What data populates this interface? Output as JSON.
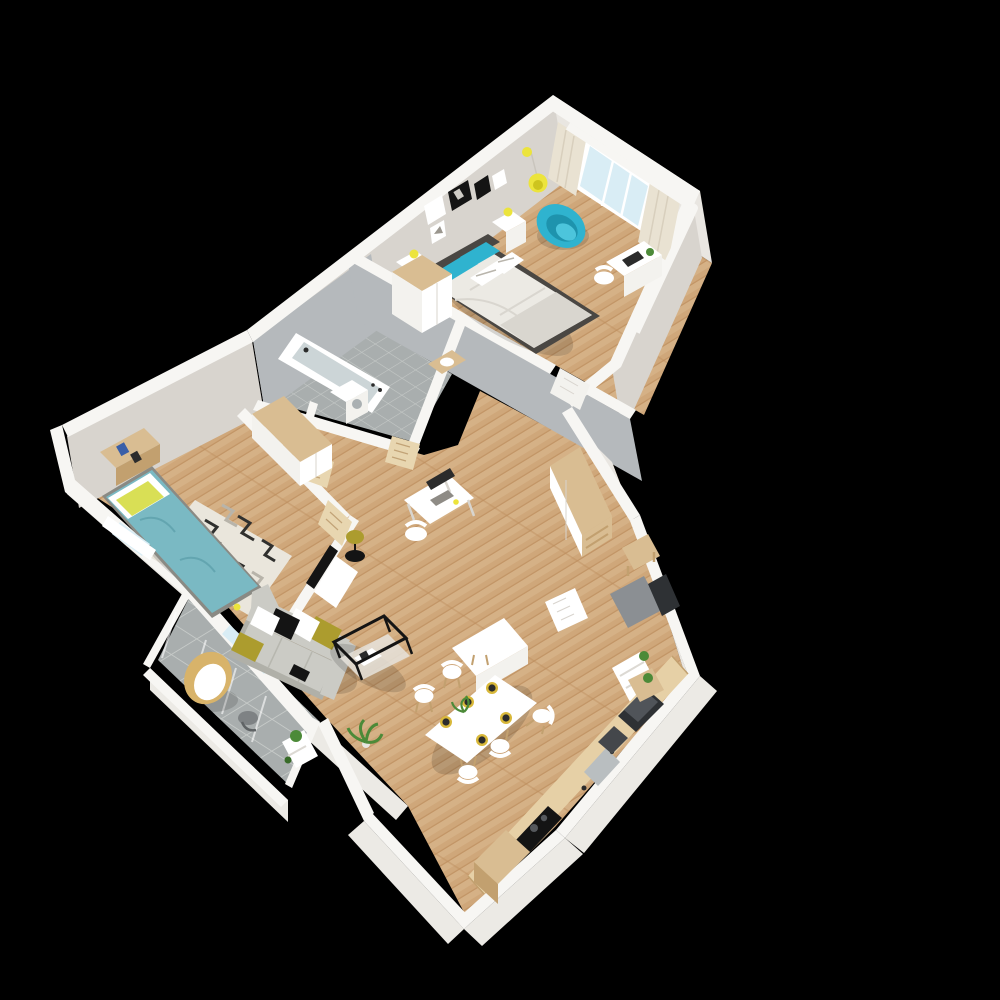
{
  "scene": {
    "type": "3d-floor-plan-render",
    "view": "isometric-top-down",
    "background": "#000000",
    "description": "3D rendered floor plan of a two-bedroom apartment with furniture, shown floating on a black background"
  },
  "palette": {
    "bg": "#000000",
    "wallTop": "#f7f6f3",
    "wallFaceLight": "#e9e6e1",
    "wallFaceShade": "#d8d4ce",
    "wallFaceGrey": "#b5b9bc",
    "wallSkirt": "#eceae5",
    "floorWood": "#cfa77a",
    "floorWoodLight": "#ddbf95",
    "floorWoodDark": "#bd8f5e",
    "tileGrey": "#a9aeae",
    "tileGrout": "#c6cac8",
    "teal": "#2fb3cf",
    "tealDark": "#1e93ad",
    "tealLight": "#4cc5dc",
    "kidsTeal": "#7ab9c3",
    "kidsTealDark": "#63a5b0",
    "yellow": "#ece43c",
    "yellowPillow": "#d9df55",
    "olive": "#ac9c2e",
    "sofaGrey": "#cbcbc5",
    "sofaGreyDark": "#b0b0a8",
    "white": "#ffffff",
    "offWhite": "#f3f2ee",
    "woodFurn": "#d9bd92",
    "woodFurnDark": "#c2a06f",
    "counterWood": "#e6d0a6",
    "dark": "#2b2b2b",
    "black": "#141414",
    "appliance": "#44474b",
    "applianceDark": "#2e3134",
    "plantGreen": "#4c8a38",
    "plantGreenDark": "#386b28",
    "glass": "#d9edf5",
    "doorWood": "#e8d6b0",
    "doorWoodLine": "#c2a377",
    "mat": "#8b8f93",
    "headboard": "#4a4743",
    "bedWhite": "#eceae4",
    "bedWhiteShade": "#d9d6cf",
    "rugBase": "#eae6dc",
    "rugZig": "#30302e",
    "rugZigGrey": "#b8b4aa",
    "gold": "#d8b83a",
    "plate": "#2c2c2c",
    "rattan": "#d8b36a"
  },
  "rooms": [
    {
      "id": "master-bedroom",
      "furniture": [
        "double-bed",
        "teal-pillows",
        "headboard",
        "two-nightstands",
        "yellow-table-lamps",
        "wall-picture-frames",
        "wardrobe",
        "teal-swivel-chair",
        "yellow-pendant-lamp",
        "window-with-curtains",
        "desk-with-laptop",
        "desk-chair"
      ]
    },
    {
      "id": "bathroom",
      "furniture": [
        "bathtub",
        "washing-machine",
        "vanity-shelf",
        "wood-door"
      ]
    },
    {
      "id": "wc",
      "furniture": [
        "toilet",
        "wood-door"
      ]
    },
    {
      "id": "kids-bedroom",
      "furniture": [
        "single-bed-teal",
        "yellow-pillow",
        "wood-shelf-unit",
        "wardrobe",
        "zigzag-rug",
        "window",
        "wood-door"
      ]
    },
    {
      "id": "hallway",
      "furniture": [
        "tall-wardrobe-wood-top",
        "open-shelf-column",
        "white-door-leaf"
      ]
    },
    {
      "id": "entrance",
      "furniture": [
        "front-door-dark",
        "doormat",
        "wood-bench",
        "shoe-shelf-with-plant"
      ]
    },
    {
      "id": "living-room",
      "furniture": [
        "grey-sofa",
        "throw-pillows",
        "coffee-table-black-frame",
        "tv-on-wall",
        "tv-console",
        "floor-lamp-side-table",
        "computer-desk",
        "desk-chair",
        "potted-plant"
      ]
    },
    {
      "id": "dining-area",
      "furniture": [
        "white-dining-table",
        "six-chairs",
        "gold-charger-plates",
        "centerpiece-plant",
        "white-sideboard"
      ]
    },
    {
      "id": "kitchen",
      "furniture": [
        "wood-counter",
        "black-cooktop",
        "sink",
        "coffee-machine",
        "dark-oven",
        "wood-cabinet",
        "corner-shelf-plant"
      ]
    },
    {
      "id": "balcony",
      "furniture": [
        "hanging-rattan-chair",
        "small-round-table",
        "plant-shelf",
        "glass-railing"
      ]
    }
  ],
  "counts": {
    "dining_chairs": 6,
    "charger_plates": 5,
    "wall_frames": 4,
    "sofa_pillows": 5,
    "master_bed_pillows": 4
  }
}
